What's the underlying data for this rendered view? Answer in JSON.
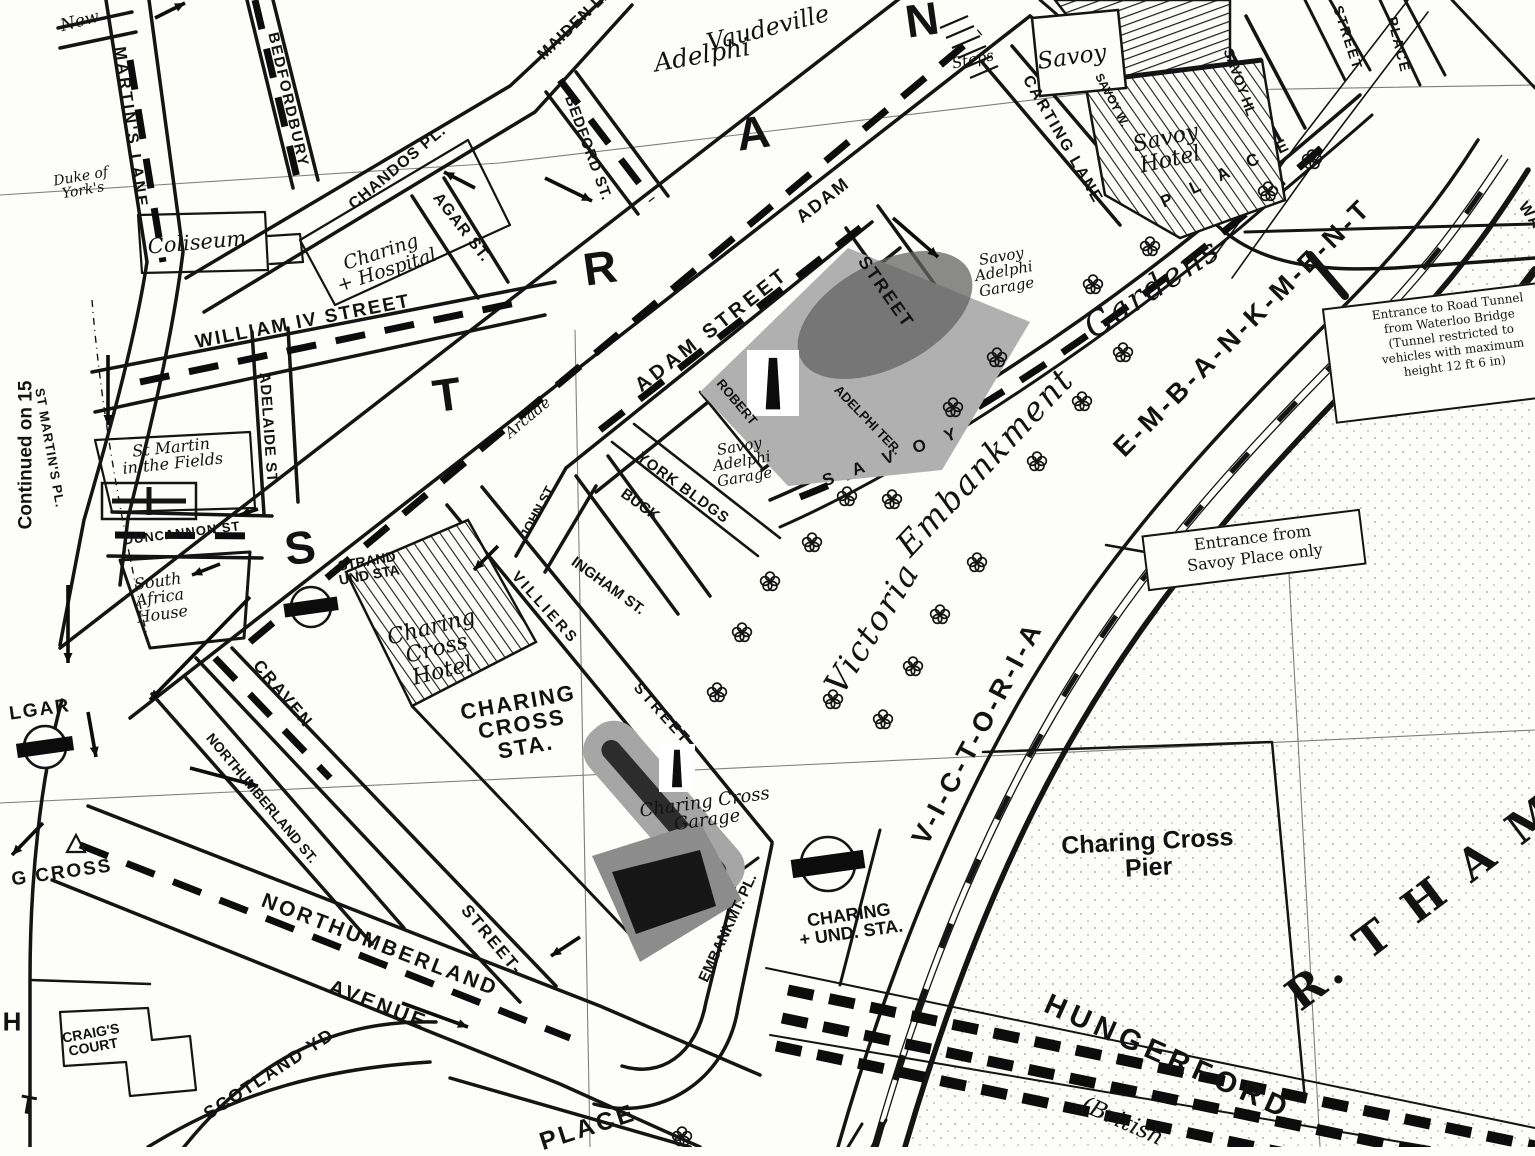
{
  "map": {
    "title": "Street map — Charing Cross, Strand and Victoria Embankment",
    "paper_color": "#fdfdfa",
    "ink_color": "#141414",
    "block_gray": "#b0b0b0",
    "block_dark": "#3a3a3a",
    "labels": [
      {
        "name": "label-continued-on-15",
        "text": "Continued on 15",
        "x": 26,
        "y": 455,
        "rot": -90,
        "size": 19,
        "weight": 700
      },
      {
        "name": "label-new-row",
        "text": "New",
        "x": 80,
        "y": 22,
        "rot": -15,
        "size": 17,
        "italic": true,
        "serif": true
      },
      {
        "name": "label-st-martins-lane",
        "text": "MARTIN'S LANE",
        "x": 130,
        "y": 128,
        "rot": 82,
        "size": 16,
        "weight": 700,
        "spacing": 3
      },
      {
        "name": "label-st-martins-pl",
        "text": "ST MARTIN'S PL.",
        "x": 50,
        "y": 448,
        "rot": 80,
        "size": 13,
        "weight": 700,
        "spacing": 1
      },
      {
        "name": "label-bedfordbury",
        "text": "BEDFORDBURY",
        "x": 288,
        "y": 100,
        "rot": 77,
        "size": 15,
        "weight": 700,
        "spacing": 2
      },
      {
        "name": "label-duke-of-yorks",
        "lines": [
          "Duke of",
          "York's"
        ],
        "x": 82,
        "y": 184,
        "rot": -10,
        "size": 14,
        "italic": true,
        "serif": true
      },
      {
        "name": "label-coliseum",
        "text": "Coliseum",
        "x": 197,
        "y": 243,
        "rot": -5,
        "size": 21,
        "italic": true,
        "serif": true
      },
      {
        "name": "label-chandos-pl",
        "text": "CHANDOS PL.",
        "x": 398,
        "y": 168,
        "rot": -40,
        "size": 16,
        "weight": 700,
        "spacing": 1
      },
      {
        "name": "label-agar-st",
        "text": "AGAR ST.",
        "x": 461,
        "y": 228,
        "rot": 52,
        "size": 16,
        "weight": 700,
        "spacing": 1
      },
      {
        "name": "label-maiden-la",
        "text": "MAIDEN LA.",
        "x": 578,
        "y": 22,
        "rot": -44,
        "size": 16,
        "weight": 700,
        "spacing": 1
      },
      {
        "name": "label-bedford-st",
        "text": "BEDFORD ST.",
        "x": 588,
        "y": 148,
        "rot": 70,
        "size": 15,
        "weight": 700,
        "spacing": 1
      },
      {
        "name": "label-adelphi-theatre",
        "text": "Adelphi",
        "x": 702,
        "y": 55,
        "rot": -10,
        "size": 25,
        "italic": true,
        "serif": true
      },
      {
        "name": "label-vaudeville-theatre",
        "text": "Vaudeville",
        "x": 768,
        "y": 28,
        "rot": -14,
        "size": 24,
        "italic": true,
        "serif": true
      },
      {
        "name": "label-strand-letter-s",
        "text": "S",
        "x": 300,
        "y": 548,
        "rot": -8,
        "size": 46,
        "weight": 700
      },
      {
        "name": "label-strand-letter-t",
        "text": "T",
        "x": 447,
        "y": 395,
        "rot": -8,
        "size": 46,
        "weight": 700
      },
      {
        "name": "label-strand-letter-r",
        "text": "R",
        "x": 600,
        "y": 268,
        "rot": -8,
        "size": 46,
        "weight": 700
      },
      {
        "name": "label-strand-letter-a",
        "text": "A",
        "x": 753,
        "y": 133,
        "rot": -8,
        "size": 46,
        "weight": 700
      },
      {
        "name": "label-strand-letter-n",
        "text": "N",
        "x": 922,
        "y": 20,
        "rot": -8,
        "size": 46,
        "weight": 700
      },
      {
        "name": "label-steps",
        "text": "Steps",
        "x": 973,
        "y": 60,
        "rot": -12,
        "size": 15,
        "italic": true,
        "serif": true
      },
      {
        "name": "label-savoy-theatre",
        "text": "Savoy",
        "x": 1072,
        "y": 58,
        "rot": -8,
        "size": 23,
        "italic": true,
        "serif": true
      },
      {
        "name": "label-carting-lane",
        "text": "CARTING LANE",
        "x": 1062,
        "y": 140,
        "rot": 60,
        "size": 16,
        "weight": 700,
        "spacing": 2
      },
      {
        "name": "label-savoy-way",
        "text": "SAVOY W.",
        "x": 1112,
        "y": 100,
        "rot": 62,
        "size": 12,
        "weight": 700
      },
      {
        "name": "label-savoy-hotel",
        "lines": [
          "Savoy",
          "Hotel"
        ],
        "x": 1168,
        "y": 150,
        "rot": -12,
        "size": 22,
        "italic": true,
        "serif": true
      },
      {
        "name": "label-savoy-hill",
        "text": "SAVOY HL",
        "x": 1240,
        "y": 82,
        "rot": 70,
        "size": 14,
        "weight": 700
      },
      {
        "name": "label-savoy-street",
        "text": "STREET",
        "x": 1348,
        "y": 38,
        "rot": 72,
        "size": 14,
        "weight": 700,
        "spacing": 2
      },
      {
        "name": "label-savoy-place-vertical",
        "text": "PLACE",
        "x": 1399,
        "y": 45,
        "rot": 76,
        "size": 14,
        "weight": 700,
        "spacing": 2
      },
      {
        "name": "label-savoy-place-letters-savoy",
        "text": "S A V O Y",
        "x": 893,
        "y": 456,
        "rot": -20,
        "size": 17,
        "weight": 700,
        "spacing": 8
      },
      {
        "name": "label-savoy-place-letters-place",
        "text": "P L A C E",
        "x": 1228,
        "y": 172,
        "rot": -25,
        "size": 17,
        "weight": 700,
        "spacing": 8
      },
      {
        "name": "label-adam-street",
        "text": "ADAM STREET",
        "x": 712,
        "y": 330,
        "rot": -38,
        "size": 20,
        "weight": 700,
        "spacing": 4
      },
      {
        "name": "label-adam-street-2",
        "text": "ADAM",
        "x": 823,
        "y": 200,
        "rot": -38,
        "size": 18,
        "weight": 700,
        "spacing": 2
      },
      {
        "name": "label-adam-street-2b",
        "text": "STREET",
        "x": 886,
        "y": 292,
        "rot": 55,
        "size": 18,
        "weight": 700,
        "spacing": 2
      },
      {
        "name": "label-john-st",
        "text": "JOHN ST",
        "x": 537,
        "y": 512,
        "rot": -62,
        "size": 13,
        "weight": 700
      },
      {
        "name": "label-york-bldgs",
        "text": "YORK BLDGS",
        "x": 683,
        "y": 488,
        "rot": 36,
        "size": 15,
        "weight": 700,
        "spacing": 1
      },
      {
        "name": "label-buckingham-st-1",
        "text": "BUCK",
        "x": 640,
        "y": 505,
        "rot": 36,
        "size": 15,
        "weight": 700
      },
      {
        "name": "label-buckingham-st-2",
        "text": "INGHAM ST.",
        "x": 608,
        "y": 586,
        "rot": 36,
        "size": 15,
        "weight": 700
      },
      {
        "name": "label-arcade",
        "text": "Arcade",
        "x": 528,
        "y": 418,
        "rot": -40,
        "size": 15,
        "italic": true,
        "serif": true
      },
      {
        "name": "label-robert-st",
        "text": "ROBERT",
        "x": 737,
        "y": 402,
        "rot": 50,
        "size": 13,
        "weight": 700
      },
      {
        "name": "label-adelphi-terrace",
        "text": "ADELPHI TER.",
        "x": 868,
        "y": 420,
        "rot": 46,
        "size": 13,
        "weight": 700
      },
      {
        "name": "label-savoy-adelphi-garage-north",
        "lines": [
          "Savoy",
          "Adelphi",
          "Garage"
        ],
        "x": 1004,
        "y": 272,
        "rot": -10,
        "size": 15,
        "italic": true,
        "serif": true
      },
      {
        "name": "label-savoy-adelphi-garage-south",
        "lines": [
          "Savoy",
          "Adelphi",
          "Garage"
        ],
        "x": 742,
        "y": 462,
        "rot": -10,
        "size": 15,
        "italic": true,
        "serif": true
      },
      {
        "name": "label-gardens-victoria",
        "text": "Victoria",
        "x": 872,
        "y": 628,
        "rot": -58,
        "size": 33,
        "italic": true,
        "serif": true,
        "spacing": 2
      },
      {
        "name": "label-gardens-embankment",
        "text": "Embankment",
        "x": 985,
        "y": 462,
        "rot": -47,
        "size": 33,
        "italic": true,
        "serif": true,
        "spacing": 2
      },
      {
        "name": "label-gardens-gardens",
        "text": "Gardens",
        "x": 1152,
        "y": 288,
        "rot": -33,
        "size": 33,
        "italic": true,
        "serif": true,
        "spacing": 2
      },
      {
        "name": "label-victoria-road",
        "text": "V-I-C-T-O-R-I-A",
        "x": 978,
        "y": 733,
        "rot": -62,
        "size": 27,
        "weight": 700,
        "spacing": 4
      },
      {
        "name": "label-embankment-road",
        "text": "E-M-B-A-N-K-M-E-N-T",
        "x": 1243,
        "y": 328,
        "rot": -45,
        "size": 27,
        "weight": 700,
        "spacing": 4
      },
      {
        "name": "label-waterloo",
        "text": "WATERLOO",
        "x": 1552,
        "y": 248,
        "rot": 55,
        "size": 16,
        "weight": 700,
        "spacing": 2
      },
      {
        "name": "label-charing-hospital",
        "lines": [
          "Charing",
          "+ Hospital"
        ],
        "x": 384,
        "y": 262,
        "rot": -18,
        "size": 19,
        "italic": true,
        "serif": true
      },
      {
        "name": "label-william-iv-street",
        "text": "WILLIAM IV STREET",
        "x": 303,
        "y": 322,
        "rot": -11,
        "size": 19,
        "weight": 700,
        "spacing": 2
      },
      {
        "name": "label-adelaide-st",
        "text": "ADELAIDE ST",
        "x": 268,
        "y": 428,
        "rot": 86,
        "size": 15,
        "weight": 700,
        "spacing": 1
      },
      {
        "name": "label-st-martin-in-the-fields",
        "lines": [
          "St Martin",
          "in the Fields"
        ],
        "x": 172,
        "y": 456,
        "rot": -6,
        "size": 16,
        "italic": true,
        "serif": true
      },
      {
        "name": "label-duncannon-st",
        "text": "DUNCANNON ST",
        "x": 182,
        "y": 533,
        "rot": -7,
        "size": 13,
        "weight": 700,
        "spacing": 1
      },
      {
        "name": "label-south-africa-house",
        "lines": [
          "South",
          "Africa",
          "House"
        ],
        "x": 160,
        "y": 598,
        "rot": -8,
        "size": 16,
        "italic": true,
        "serif": true
      },
      {
        "name": "label-strand-und-sta",
        "lines": [
          "STRAND",
          "UND STA"
        ],
        "x": 368,
        "y": 568,
        "rot": -10,
        "size": 14,
        "weight": 700
      },
      {
        "name": "label-charing-cross-hotel",
        "lines": [
          "Charing",
          "Cross",
          "Hotel"
        ],
        "x": 437,
        "y": 650,
        "rot": -14,
        "size": 22,
        "italic": true,
        "serif": true
      },
      {
        "name": "label-charing-cross-sta",
        "lines": [
          "CHARING",
          "CROSS",
          "STA."
        ],
        "x": 522,
        "y": 725,
        "rot": -10,
        "size": 22,
        "weight": 700,
        "spacing": 2
      },
      {
        "name": "label-villiers",
        "text": "VILLIERS",
        "x": 545,
        "y": 608,
        "rot": 48,
        "size": 15,
        "weight": 700,
        "spacing": 3
      },
      {
        "name": "label-villiers-street",
        "text": "STREET",
        "x": 662,
        "y": 714,
        "rot": 48,
        "size": 15,
        "weight": 700,
        "spacing": 3
      },
      {
        "name": "label-craven",
        "text": "CRAVEN",
        "x": 283,
        "y": 694,
        "rot": 50,
        "size": 17,
        "weight": 700,
        "spacing": 2
      },
      {
        "name": "label-craven-street",
        "text": "STREET-",
        "x": 492,
        "y": 940,
        "rot": 50,
        "size": 17,
        "weight": 700,
        "spacing": 2
      },
      {
        "name": "label-northumberland-st",
        "text": "NORTHUMBERLAND ST.",
        "x": 262,
        "y": 798,
        "rot": 50,
        "size": 14,
        "weight": 700
      },
      {
        "name": "label-northumberland-avenue-1",
        "text": "NORTHUMBERLAND",
        "x": 380,
        "y": 945,
        "rot": 21,
        "size": 21,
        "weight": 700,
        "spacing": 3
      },
      {
        "name": "label-northumberland-avenue-2",
        "text": "AVENUE",
        "x": 378,
        "y": 1005,
        "rot": 21,
        "size": 21,
        "weight": 700,
        "spacing": 3
      },
      {
        "name": "label-charing-cross-cut",
        "text": "G CROSS",
        "x": 62,
        "y": 873,
        "rot": -8,
        "size": 19,
        "weight": 700,
        "spacing": 2
      },
      {
        "name": "label-trafalgar-cut",
        "text": "LGAR",
        "x": 40,
        "y": 710,
        "rot": -8,
        "size": 19,
        "weight": 700,
        "spacing": 2
      },
      {
        "name": "label-whitehall-h",
        "text": "H",
        "x": 12,
        "y": 1022,
        "rot": 0,
        "size": 26,
        "weight": 700
      },
      {
        "name": "label-whitehall-t",
        "text": "T",
        "x": 28,
        "y": 1105,
        "rot": 10,
        "size": 26,
        "weight": 700
      },
      {
        "name": "label-craigs-court",
        "lines": [
          "CRAIG'S",
          "COURT"
        ],
        "x": 92,
        "y": 1040,
        "rot": -10,
        "size": 14,
        "weight": 700
      },
      {
        "name": "label-scotland-yd",
        "text": "SCOTLAND YD.",
        "x": 272,
        "y": 1072,
        "rot": -33,
        "size": 18,
        "weight": 700,
        "spacing": 2
      },
      {
        "name": "label-place-bottom",
        "text": "PLACE",
        "x": 588,
        "y": 1128,
        "rot": -18,
        "size": 25,
        "weight": 700,
        "spacing": 3
      },
      {
        "name": "label-embankmt-pl",
        "text": "EMBANKMT. PL.",
        "x": 728,
        "y": 928,
        "rot": -65,
        "size": 15,
        "weight": 700
      },
      {
        "name": "label-charing-und-sta",
        "lines": [
          "CHARING",
          "+ UND. STA."
        ],
        "x": 850,
        "y": 924,
        "rot": -8,
        "size": 18,
        "weight": 700
      },
      {
        "name": "label-charing-cross-garage",
        "lines": [
          "Charing Cross",
          "Garage"
        ],
        "x": 706,
        "y": 812,
        "rot": -8,
        "size": 18,
        "italic": true,
        "serif": true
      },
      {
        "name": "label-charing-cross-pier",
        "lines": [
          "Charing Cross",
          "Pier"
        ],
        "x": 1148,
        "y": 855,
        "rot": -3,
        "size": 25,
        "weight": 600
      },
      {
        "name": "label-hungerford",
        "text": "HUNGERFORD",
        "x": 1168,
        "y": 1058,
        "rot": 24,
        "size": 29,
        "weight": 700,
        "spacing": 6
      },
      {
        "name": "label-british",
        "text": "(British",
        "x": 1122,
        "y": 1122,
        "rot": 24,
        "size": 23,
        "italic": true,
        "serif": true
      },
      {
        "name": "label-r-thames",
        "text": "R. T H A M E S",
        "x": 1472,
        "y": 866,
        "rot": -37,
        "size": 44,
        "weight": 700,
        "serif": true,
        "spacing": 6
      }
    ],
    "boxes": [
      {
        "name": "note-road-tunnel",
        "x": 1445,
        "y": 352,
        "w": 234,
        "h": 118,
        "rot": -7,
        "size": 12,
        "lines": [
          "Entrance to Road Tunnel",
          "from Waterloo Bridge",
          "(Tunnel restricted to",
          "vehicles with maximum",
          "height 12 ft 6 in)"
        ]
      },
      {
        "name": "note-savoy-entrance",
        "x": 1246,
        "y": 551,
        "w": 204,
        "h": 58,
        "rot": -7,
        "size": 16,
        "lines": [
          "Entrance from",
          "Savoy Place only"
        ]
      }
    ],
    "icons": {
      "roundels": [
        {
          "name": "strand-station-roundel",
          "x": 311,
          "y": 607,
          "r": 20
        },
        {
          "name": "trafalgar-station-roundel",
          "x": 45,
          "y": 747,
          "r": 21
        },
        {
          "name": "embankment-station-roundel",
          "x": 828,
          "y": 864,
          "r": 27
        }
      ],
      "monuments": [
        {
          "name": "adelphi-monument-icon",
          "x": 773,
          "y": 383,
          "w": 52,
          "h": 66
        },
        {
          "name": "charing-cross-monument-icon",
          "x": 677,
          "y": 768,
          "w": 36,
          "h": 48
        }
      ],
      "trees": [
        [
          1312,
          160
        ],
        [
          1268,
          192
        ],
        [
          1150,
          247
        ],
        [
          1093,
          285
        ],
        [
          1123,
          353
        ],
        [
          997,
          358
        ],
        [
          1082,
          402
        ],
        [
          953,
          408
        ],
        [
          1037,
          462
        ],
        [
          892,
          500
        ],
        [
          847,
          497
        ],
        [
          812,
          543
        ],
        [
          977,
          563
        ],
        [
          940,
          615
        ],
        [
          770,
          582
        ],
        [
          742,
          633
        ],
        [
          913,
          667
        ],
        [
          833,
          700
        ],
        [
          883,
          720
        ],
        [
          717,
          693
        ],
        [
          682,
          1137
        ]
      ]
    },
    "arrows": [
      [
        108,
        355,
        108,
        425
      ],
      [
        68,
        585,
        68,
        663
      ],
      [
        88,
        712,
        96,
        757
      ],
      [
        43,
        823,
        12,
        855
      ],
      [
        250,
        597,
        150,
        700
      ],
      [
        220,
        564,
        192,
        575
      ],
      [
        258,
        509,
        240,
        515
      ],
      [
        190,
        768,
        258,
        786
      ],
      [
        545,
        178,
        592,
        201
      ],
      [
        475,
        188,
        444,
        172
      ],
      [
        893,
        218,
        938,
        257
      ],
      [
        498,
        546,
        474,
        570
      ],
      [
        580,
        937,
        551,
        956
      ],
      [
        155,
        18,
        185,
        3
      ],
      [
        402,
        1003,
        468,
        1027
      ]
    ]
  }
}
